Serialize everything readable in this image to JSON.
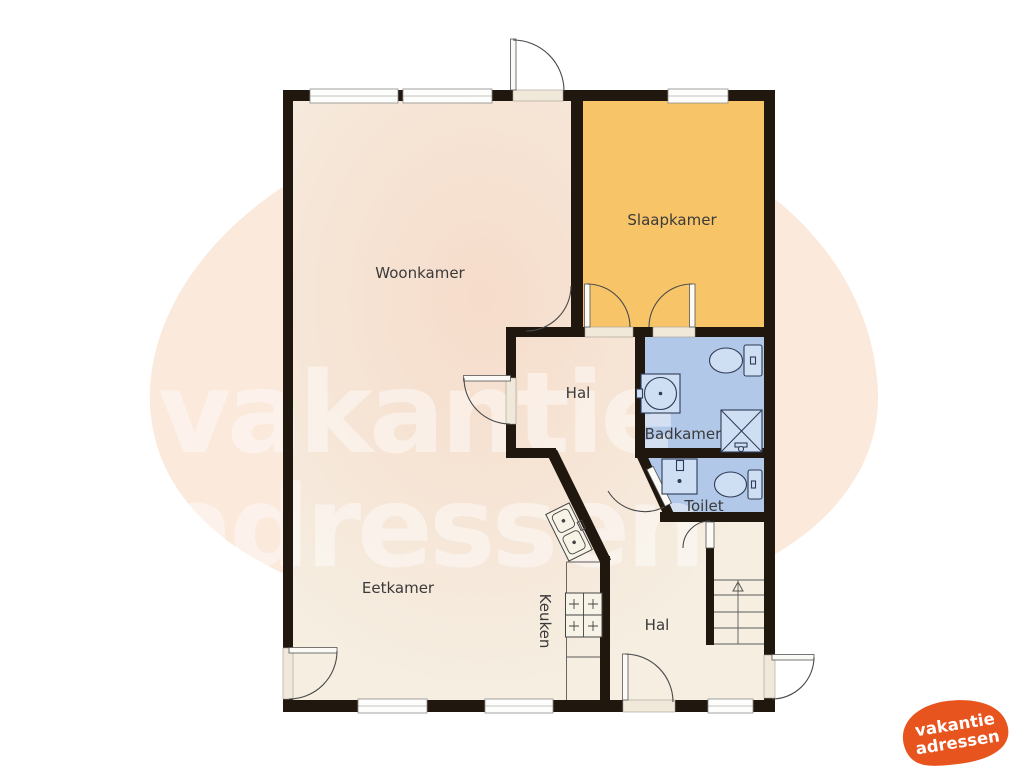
{
  "watermark": {
    "line1": "vakantie",
    "line2": "adressen",
    "color": "#ffffff"
  },
  "brand_logo": {
    "line1": "vakantie",
    "line2": "adressen",
    "bg_color": "#e8541d",
    "text_color": "#ffffff"
  },
  "rooms": [
    {
      "id": "woonkamer",
      "label": "Woonkamer",
      "color": "#f5eee1"
    },
    {
      "id": "slaapkamer",
      "label": "Slaapkamer",
      "color": "#f8c468"
    },
    {
      "id": "hal",
      "label": "Hal",
      "color": "#f5eee1"
    },
    {
      "id": "badkamer",
      "label": "Badkamer",
      "color": "#b2c8e9"
    },
    {
      "id": "toilet",
      "label": "Toilet",
      "color": "#b2c8e9"
    },
    {
      "id": "eetkamer",
      "label": "Eetkamer",
      "color": "#f5eee1"
    },
    {
      "id": "keuken",
      "label": "Keuken",
      "color": "#f5eee1"
    },
    {
      "id": "hal2",
      "label": "Hal",
      "color": "#f5eee1"
    }
  ],
  "palette": {
    "wall": "#20170f",
    "background": "#ffffff",
    "blob": "#fbe9dc",
    "tint": "#f8cdb8",
    "label_text": "#3a3a3a",
    "fixture_outline": "#2e3a57",
    "fixture_fill": "#cfdff3"
  },
  "fixtures": {
    "badkamer": [
      "toilet-icon",
      "round-sink-icon",
      "shower-icon"
    ],
    "toilet_room": [
      "square-sink-icon",
      "toilet-icon"
    ],
    "keuken": [
      "double-sink-icon",
      "stove-icon"
    ],
    "hal2": [
      "staircase-up-icon"
    ]
  }
}
